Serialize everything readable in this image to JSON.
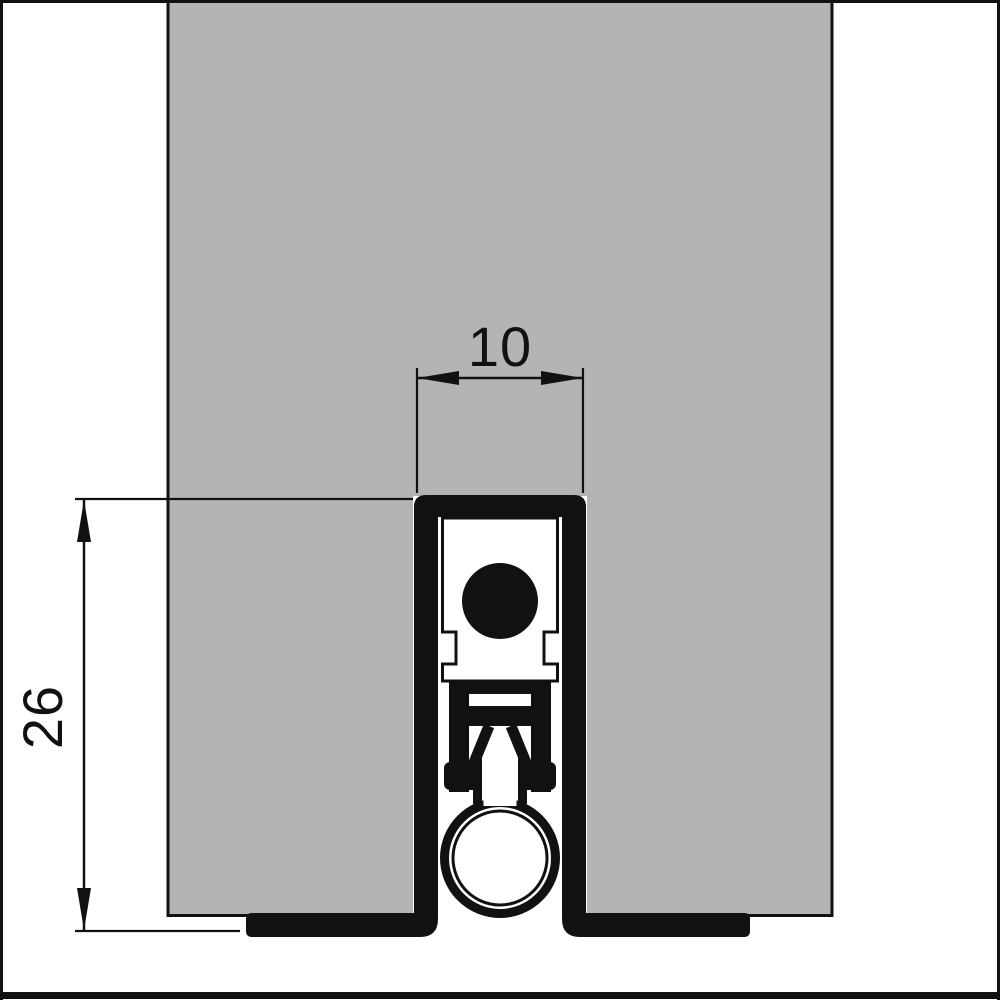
{
  "drawing": {
    "subject": "door bottom drop-seal cross-section",
    "dimensions": {
      "groove_width": "10",
      "seal_height": "26"
    },
    "colors": {
      "door_fill": "#b4b4b4",
      "line": "#111111",
      "background": "#ffffff"
    }
  }
}
